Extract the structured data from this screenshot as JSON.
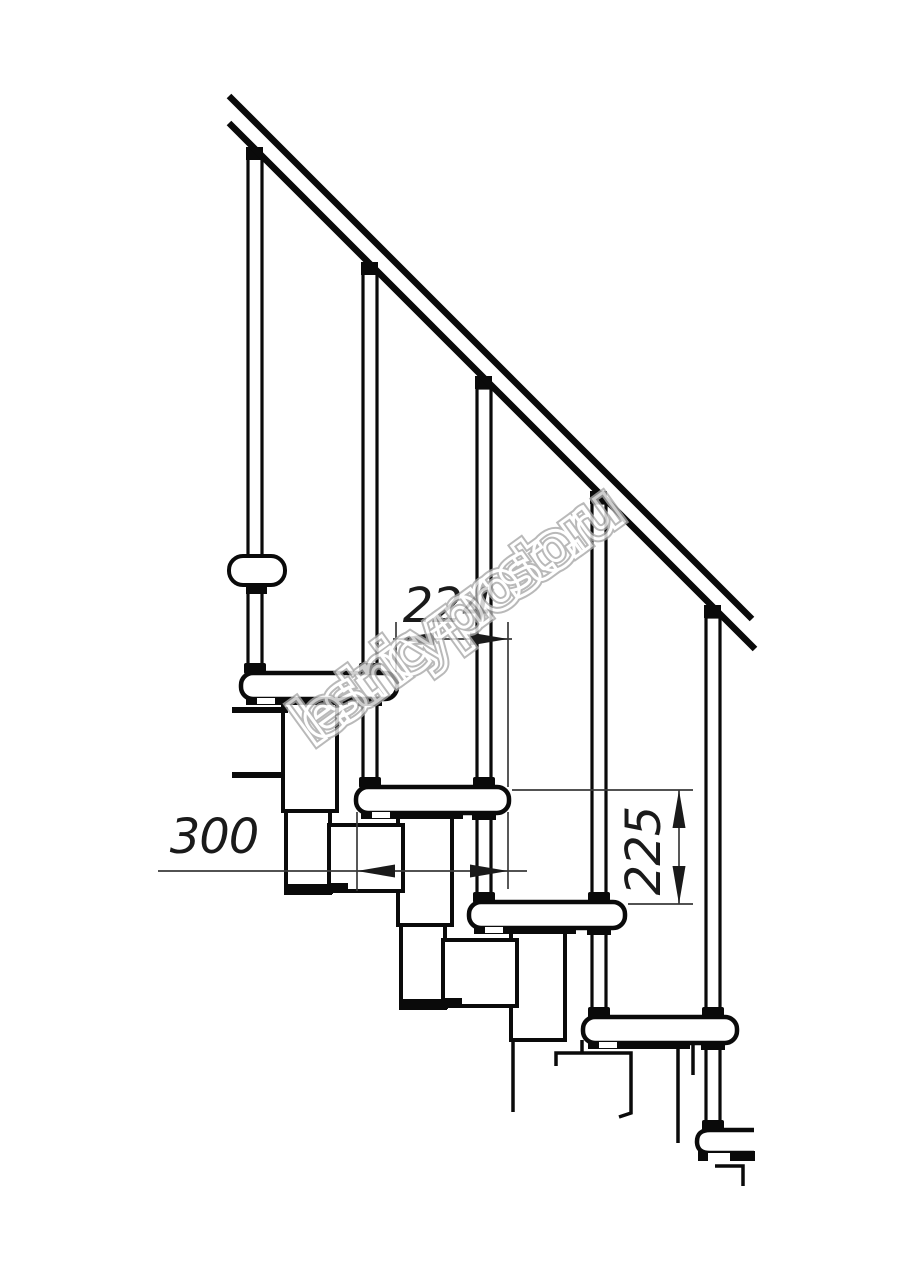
{
  "watermark": {
    "text": "lestnicy-prosto.ru",
    "color": "#a8a8a8"
  },
  "dimensions": {
    "step_run": {
      "value": "224"
    },
    "tread_depth": {
      "value": "300"
    },
    "riser_height": {
      "value": "225"
    }
  },
  "colors": {
    "background": "#ffffff",
    "outline": "#0a0a0a",
    "dimension_lines": "#3a3a3a"
  }
}
